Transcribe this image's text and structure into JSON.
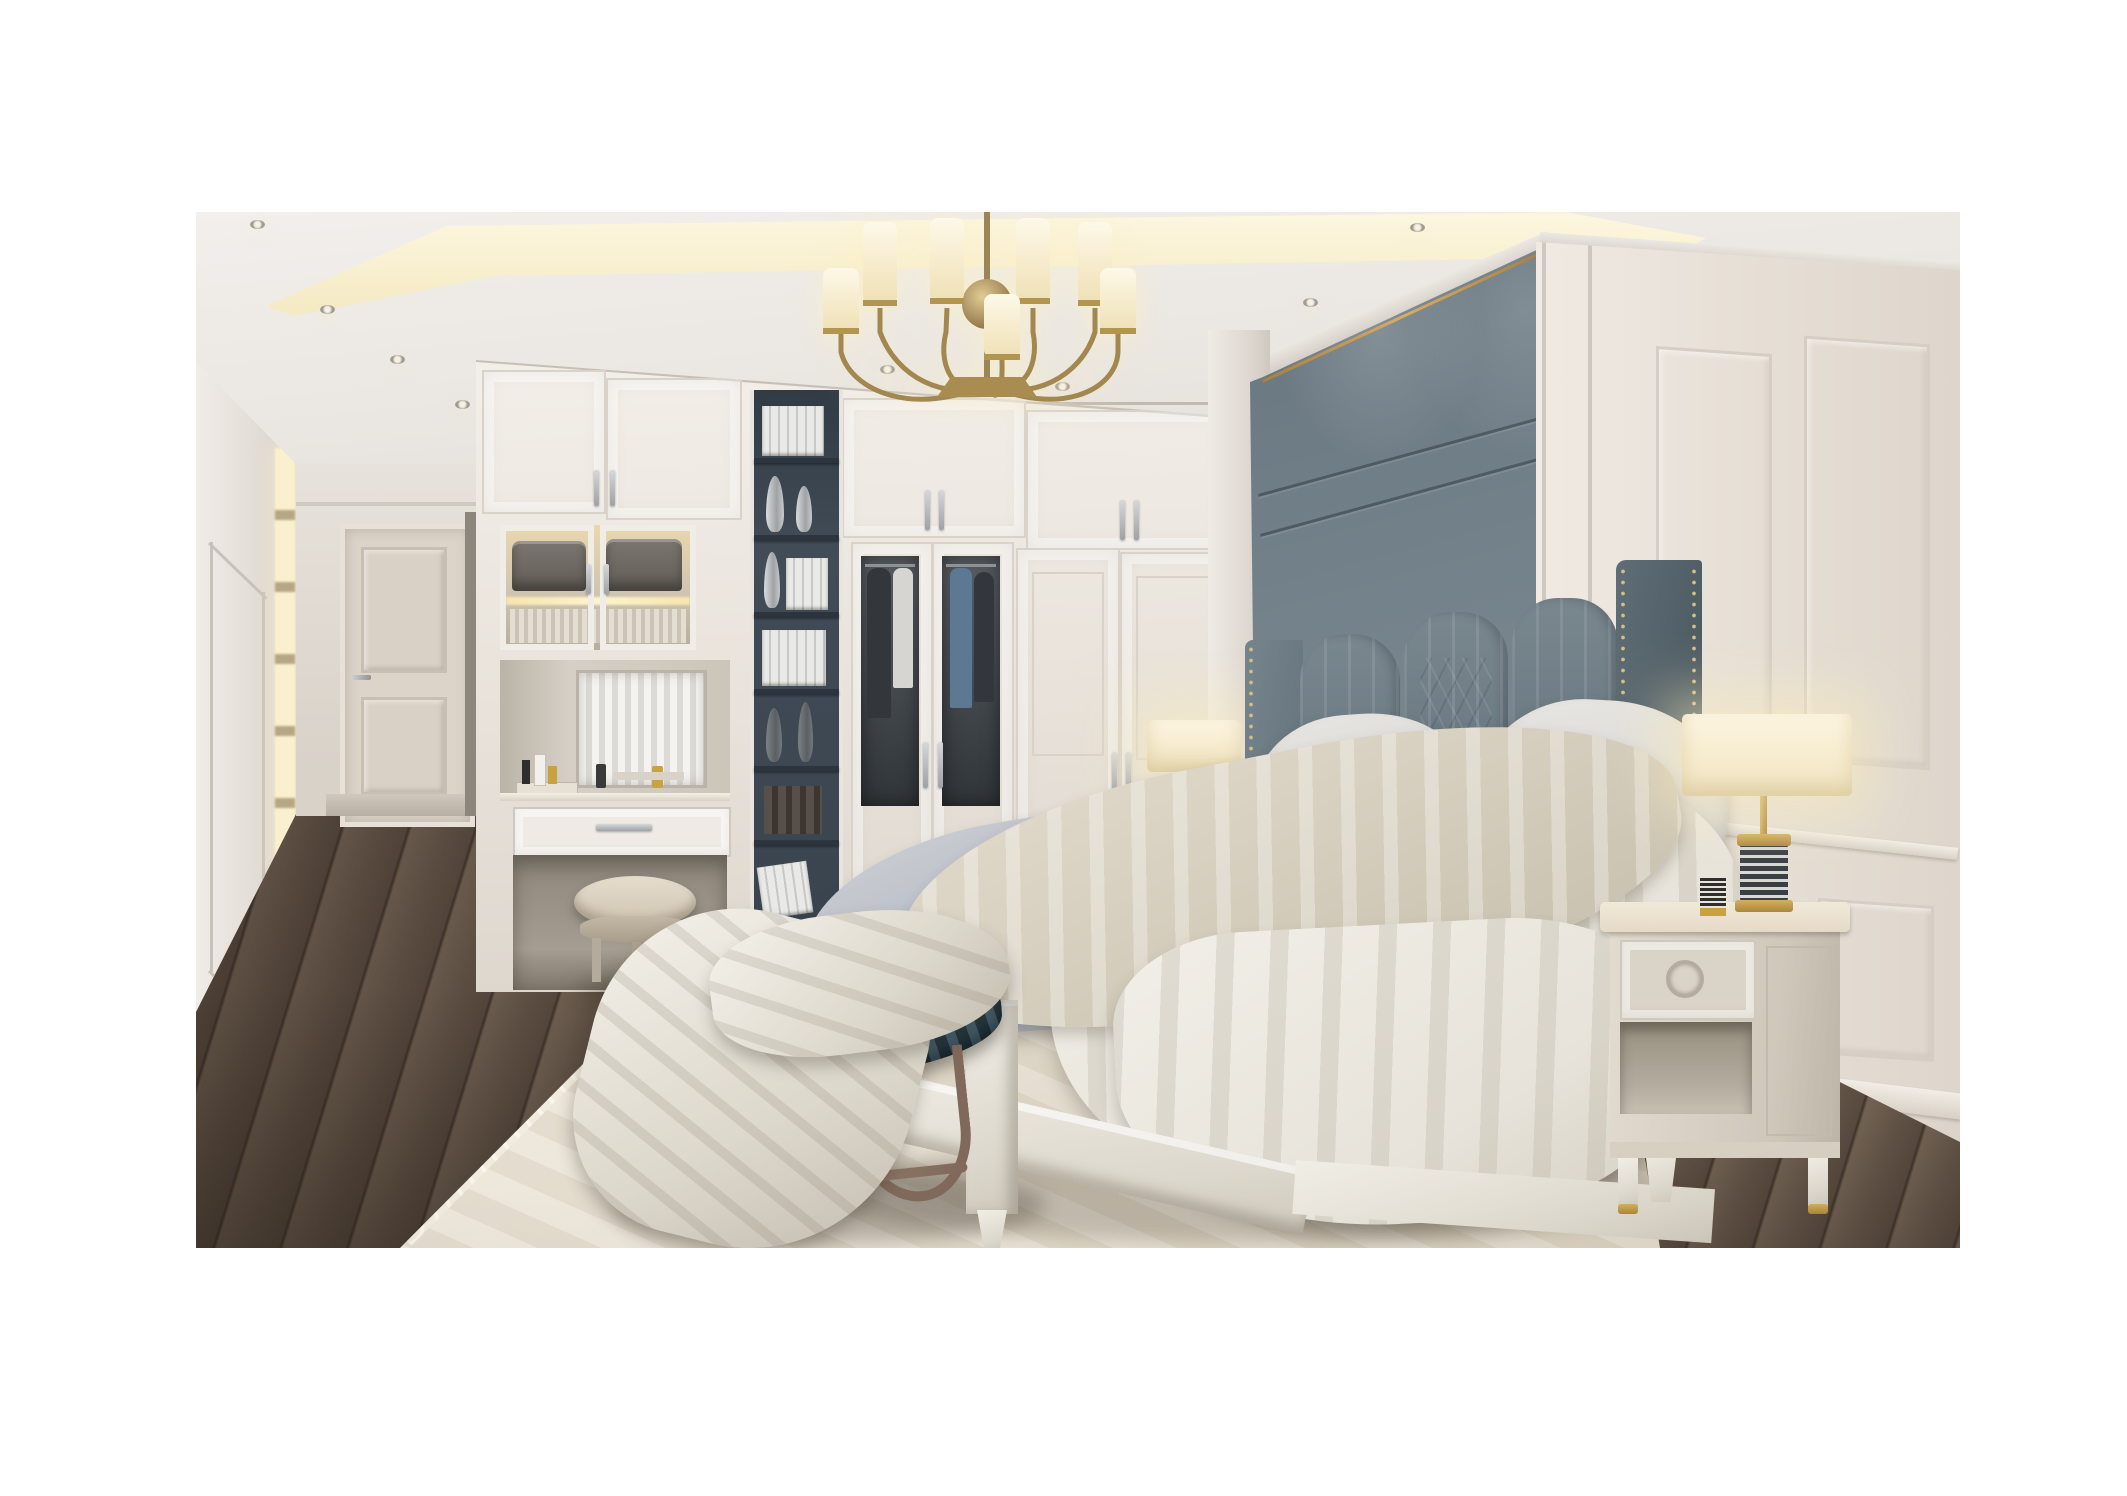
{
  "image": {
    "kind": "photorealistic 3d interior render",
    "room": "luxury neoclassical bedroom with built-in wardrobe and corridor",
    "contains_text": false
  },
  "scene": {
    "objects": [
      "coved ceiling with warm led strip and recessed spotlights",
      "brass chandelier with cylindrical white shades",
      "corridor with paneled left wall, lit display niches and cream door",
      "built-in white wardrobe with upper cabinets and long silver handles",
      "glass-front display cabinet with folded textiles",
      "vanity niche with mirror, cosmetics and drawer",
      "round leather vanity stool",
      "dark open bookshelf column with white books and silver vases",
      "wardrobe doors with smoked-glass inserts showing clothes",
      "blue-gray upholstered accent wall with brass trim",
      "channel-tufted wingback headboard with nailhead trim",
      "bed with gray duvet, beige throw and white sheet",
      "white, blue-gray and striped taupe pillows",
      "two table lamps with striped cylinder bases and glowing shades",
      "left nightstand",
      "right nightstand with ring pull drawer and brass feet",
      "oval bench with teal and gold leaf-patterned cushion on bronze base",
      "white cloth draped over bench",
      "cream patterned area rug",
      "dark stained diagonal plank wood floor",
      "right wall wainscot paneling with chair rail and baseboard"
    ]
  },
  "palette": {
    "white": "#ffffff",
    "ceiling": "#f2efec",
    "ceilingShade": "#dcd7d0",
    "coveGlow": "#f4e9c2",
    "coveBright": "#fdf7e0",
    "trayLine": "#c1bab1",
    "wallCream": "#e9e4de",
    "panelLine": "#c9c2b9",
    "doorCream": "#dcd4c9",
    "cabinetWhite": "#f3efe9",
    "cabinetShade": "#ddd6cd",
    "handleSilver": "#9ea2a5",
    "displayGlow": "#e9d7ad",
    "towelDark": "#615c55",
    "shelfDark": "#414c57",
    "shelfDarker": "#313b45",
    "bookWhite": "#e9e9e7",
    "glassDark": "#2f3438",
    "clothNavy": "#33373b",
    "shirtBlue": "#5d7893",
    "accentWall": "#74828b",
    "accentWallDark": "#67757e",
    "goldTrim": "#d8ac63",
    "headboard": "#68767f",
    "pillowWhite": "#cfcdc9",
    "pillowBlue": "#7b869b",
    "pillowTaupe": "#aa9e90",
    "pillowTaupeDark": "#857868",
    "duvetGray": "#adb3bc",
    "sheetCream": "#c8c0ae",
    "sheetWhite": "#e7e3da",
    "bedFrame": "#ddd8cd",
    "nightstand": "#cfc7ba",
    "nightstandTop": "#e4dac6",
    "brass": "#a9873c",
    "brassLight": "#d4af5e",
    "lampStripe": "#3a3f45",
    "shadeGlow": "#f1e4c0",
    "benchTeal": "#2f4450",
    "benchGold": "#b08a3e",
    "metalBronze": "#80695a",
    "rug": "#e3dbcb",
    "floorMid": "#6b5b4d",
    "floorLight": "#7d6c5c",
    "floorLine": "#42362d"
  }
}
